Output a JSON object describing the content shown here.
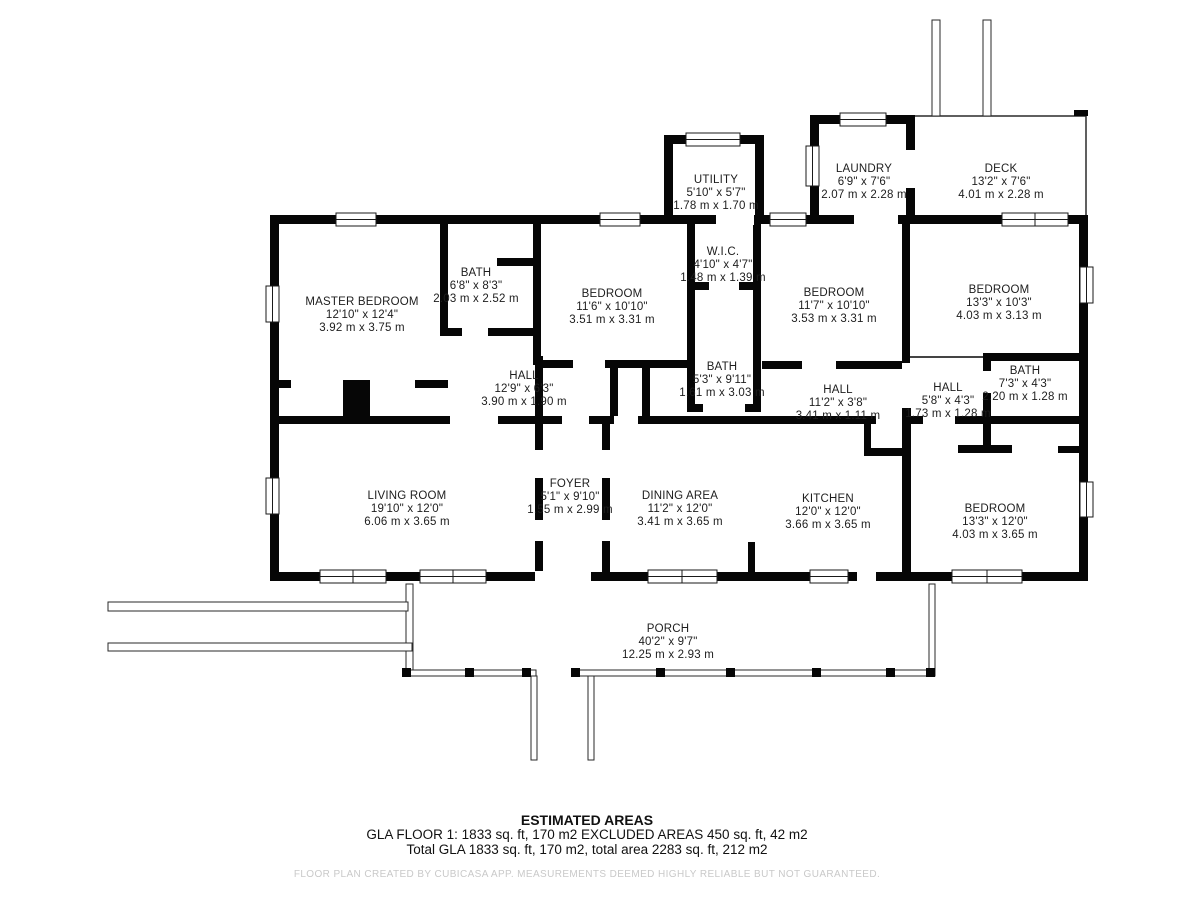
{
  "rooms": [
    {
      "name": "MASTER BEDROOM",
      "imperial": "12'10\" x 12'4\"",
      "metric": "3.92 m x 3.75 m"
    },
    {
      "name": "BATH",
      "imperial": "6'8\" x 8'3\"",
      "metric": "2.03 m x 2.52 m"
    },
    {
      "name": "BEDROOM",
      "imperial": "11'6\" x 10'10\"",
      "metric": "3.51 m x 3.31 m"
    },
    {
      "name": "W.I.C.",
      "imperial": "4'10\" x 4'7\"",
      "metric": "1.48 m x 1.39 m"
    },
    {
      "name": "UTILITY",
      "imperial": "5'10\" x 5'7\"",
      "metric": "1.78 m x 1.70 m"
    },
    {
      "name": "LAUNDRY",
      "imperial": "6'9\" x 7'6\"",
      "metric": "2.07 m x 2.28 m"
    },
    {
      "name": "DECK",
      "imperial": "13'2\" x 7'6\"",
      "metric": "4.01 m x 2.28 m"
    },
    {
      "name": "BEDROOM",
      "imperial": "11'7\" x 10'10\"",
      "metric": "3.53 m x 3.31 m"
    },
    {
      "name": "BEDROOM",
      "imperial": "13'3\" x 10'3\"",
      "metric": "4.03 m x 3.13 m"
    },
    {
      "name": "HALL",
      "imperial": "12'9\" x 6'3\"",
      "metric": "3.90 m x 1.90 m"
    },
    {
      "name": "BATH",
      "imperial": "5'3\" x 9'11\"",
      "metric": "1.61 m x 3.03 m"
    },
    {
      "name": "HALL",
      "imperial": "11'2\" x 3'8\"",
      "metric": "3.41 m x 1.11 m"
    },
    {
      "name": "HALL",
      "imperial": "5'8\" x 4'3\"",
      "metric": "1.73 m x 1.28 m"
    },
    {
      "name": "BATH",
      "imperial": "7'3\" x 4'3\"",
      "metric": "2.20 m x 1.28 m"
    },
    {
      "name": "LIVING ROOM",
      "imperial": "19'10\" x 12'0\"",
      "metric": "6.06 m x 3.65 m"
    },
    {
      "name": "FOYER",
      "imperial": "5'1\" x 9'10\"",
      "metric": "1.55 m x 2.99 m"
    },
    {
      "name": "DINING AREA",
      "imperial": "11'2\" x 12'0\"",
      "metric": "3.41 m x 3.65 m"
    },
    {
      "name": "KITCHEN",
      "imperial": "12'0\" x 12'0\"",
      "metric": "3.66 m x 3.65 m"
    },
    {
      "name": "BEDROOM",
      "imperial": "13'3\" x 12'0\"",
      "metric": "4.03 m x 3.65 m"
    },
    {
      "name": "PORCH",
      "imperial": "40'2\" x 9'7\"",
      "metric": "12.25 m x 2.93 m"
    }
  ],
  "footer": {
    "title": "ESTIMATED AREAS",
    "line1": "GLA FLOOR 1: 1833 sq. ft, 170 m2 EXCLUDED AREAS 450 sq. ft, 42 m2",
    "line2": "Total GLA 1833 sq. ft, 170 m2, total area 2283 sq. ft, 212 m2",
    "disclaimer": "FLOOR PLAN CREATED BY CUBICASA APP. MEASUREMENTS DEEMED HIGHLY RELIABLE BUT NOT GUARANTEED."
  },
  "colors": {
    "wall": "#060606",
    "thin_line": "#2a2a2a",
    "disclaimer_gray": "#c9c9c9"
  }
}
